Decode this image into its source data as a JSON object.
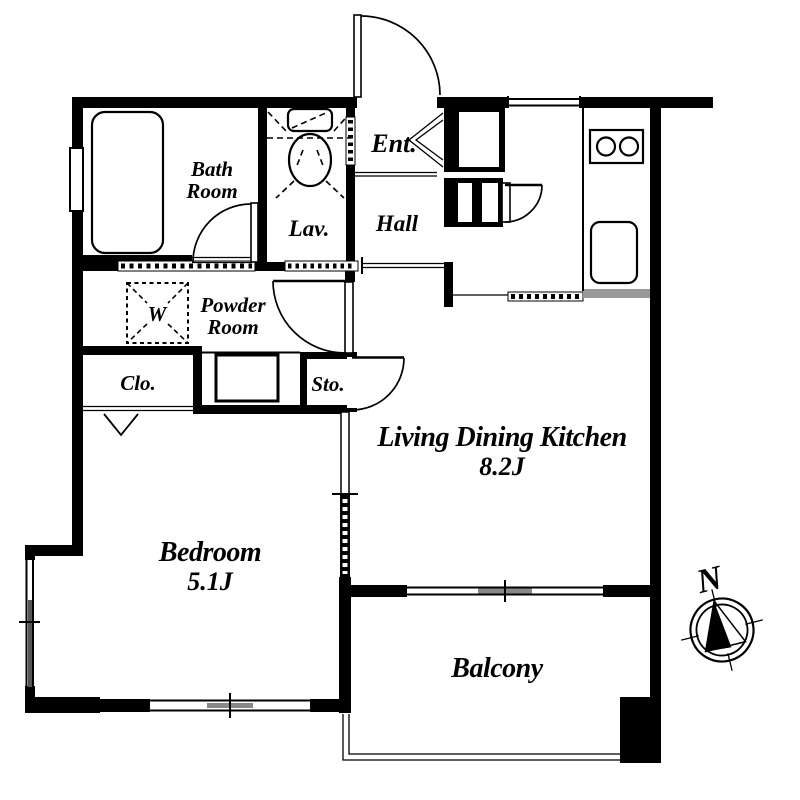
{
  "meta": {
    "kind": "apartment-floor-plan"
  },
  "rooms": {
    "bath_room": {
      "line1": "Bath",
      "line2": "Room"
    },
    "lavatory": {
      "label": "Lav."
    },
    "entrance": {
      "label": "Ent."
    },
    "hall": {
      "label": "Hall"
    },
    "powder_room": {
      "line1": "Powder",
      "line2": "Room"
    },
    "washer": {
      "label": "W"
    },
    "closet": {
      "label": "Clo."
    },
    "storage": {
      "label": "Sto."
    },
    "living": {
      "label": "Living Dining Kitchen",
      "area": "8.2J"
    },
    "bedroom": {
      "label": "Bedroom",
      "area": "5.1J"
    },
    "balcony": {
      "label": "Balcony"
    }
  },
  "compass": {
    "north_label": "N"
  },
  "icons": {
    "bathtub": "bathtub-icon",
    "toilet": "toilet-icon",
    "stove": "stove-two-burners-icon",
    "sink": "kitchen-sink-icon",
    "washing_machine": "washing-machine-space-icon",
    "vanity": "vanity-counter-icon",
    "compass": "north-compass-icon"
  },
  "colors": {
    "wall": "#000000",
    "background": "#ffffff",
    "window_accent": "#888888"
  }
}
